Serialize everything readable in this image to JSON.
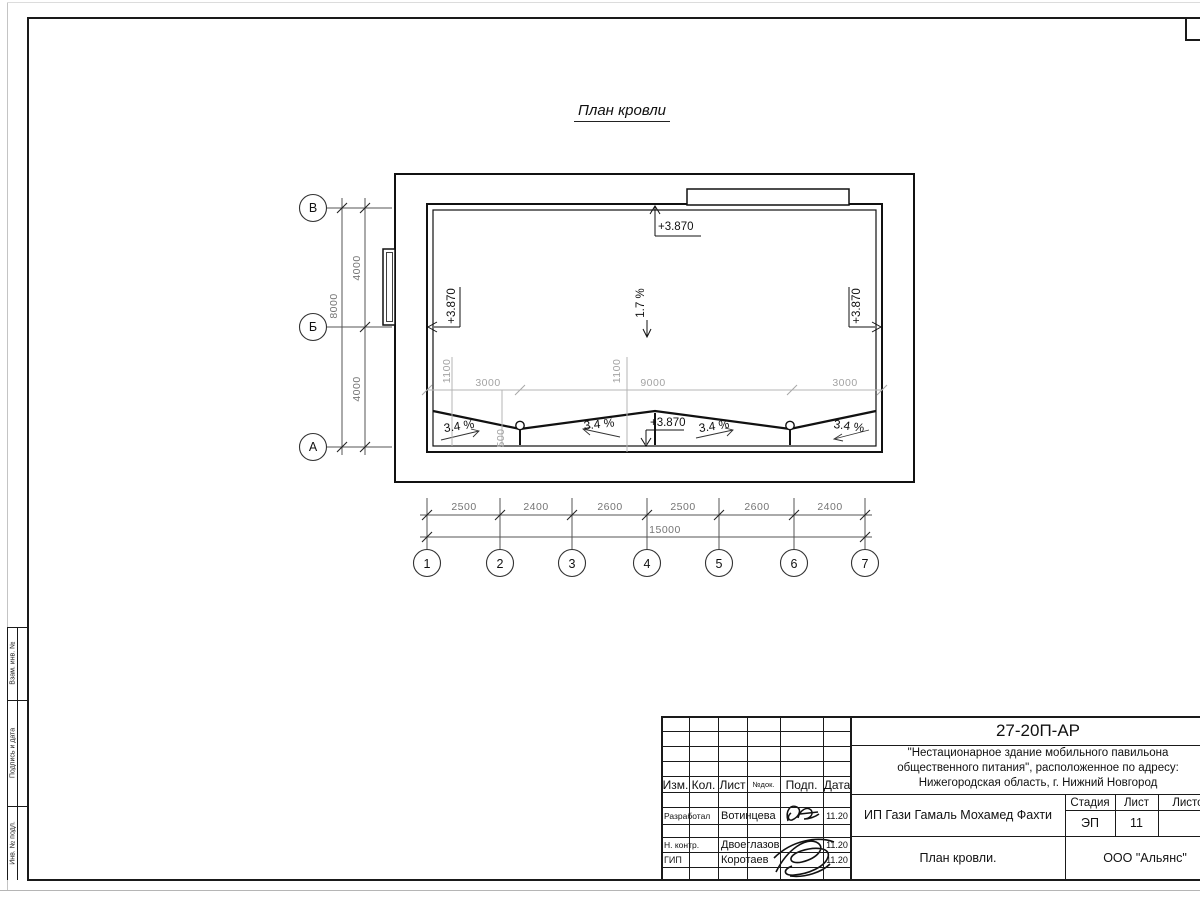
{
  "title": {
    "text": "План кровли"
  },
  "plan": {
    "elev_top": "+3.870",
    "elev_left": "+3.870",
    "elev_right": "+3.870",
    "elev_ridge": "+3.870",
    "slope_main": "1.7 %",
    "slopes": [
      "3.4 %",
      "3.4 %",
      "3.4 %",
      "3.4 %"
    ],
    "inner_dims": {
      "left_1100": "1100",
      "left_3000": "3000",
      "mid_1100": "1100",
      "mid_9000": "9000",
      "right_3000": "3000",
      "drop_500": "500"
    }
  },
  "axes": {
    "rows": [
      {
        "label": "В"
      },
      {
        "label": "Б"
      },
      {
        "label": "А"
      }
    ],
    "row_dims": [
      "4000",
      "4000"
    ],
    "row_total": "8000",
    "cols": [
      "1",
      "2",
      "3",
      "4",
      "5",
      "6",
      "7"
    ],
    "col_dims": [
      "2500",
      "2400",
      "2600",
      "2500",
      "2600",
      "2400"
    ],
    "col_total": "15000"
  },
  "frame": {
    "side_labels": [
      "Взам. инв. №",
      "Подпись и дата",
      "Инв. № подл."
    ]
  },
  "titleblock": {
    "doc_number": "27-20П-АР",
    "project_lines": [
      "\"Нестационарное здание мобильного павильона",
      "общественного питания\", расположенное по адресу:",
      "Нижегородская область, г. Нижний Новгород"
    ],
    "client": "ИП Гази Гамаль Мохамед Фахти",
    "sheet_title": "План кровли.",
    "company": "ООО \"Альянс\"",
    "columns": {
      "izm": "Изм.",
      "kol": "Кол.",
      "list": "Лист",
      "ndok": "№док.",
      "podp": "Подп.",
      "data": "Дата"
    },
    "stage": {
      "label": "Стадия",
      "value": "ЭП"
    },
    "sheet": {
      "label": "Лист",
      "value": "11"
    },
    "sheets_total": {
      "label": "Листов",
      "value": ""
    },
    "people": [
      {
        "role": "Разработал",
        "name": "Вотинцева",
        "date": "11.20"
      },
      {
        "role": "Н. контр.",
        "name": "Двоеглазов",
        "date": "11.20"
      },
      {
        "role": "ГИП",
        "name": "Коротаев",
        "date": "11.20"
      }
    ]
  }
}
